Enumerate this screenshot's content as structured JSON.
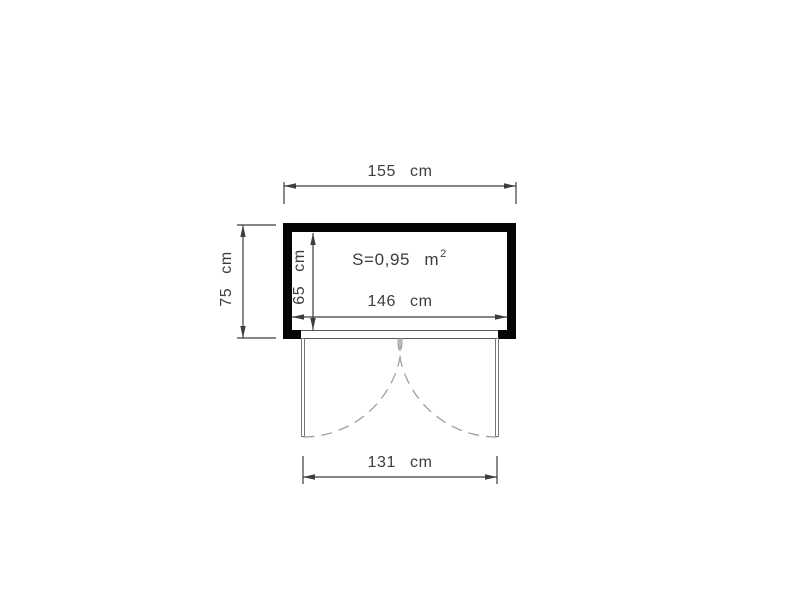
{
  "drawing": {
    "area": {
      "full_text": "S=0,95 m²",
      "prefix": "S=0,95 m",
      "exponent": "2"
    },
    "dimensions": {
      "overall_width": {
        "label": "155 cm",
        "value_cm": 155
      },
      "overall_depth": {
        "label": "75 cm",
        "value_cm": 75
      },
      "inner_depth": {
        "label": "65 cm",
        "value_cm": 65
      },
      "inner_width": {
        "label": "146 cm",
        "value_cm": 146
      },
      "door_opening_width": {
        "label": "131 cm",
        "value_cm": 131
      }
    },
    "colors": {
      "background": "#ffffff",
      "wall": "#000000",
      "dimension_line": "#3d3d3d",
      "thin_line": "#555555",
      "door_leaf_line": "#777777",
      "door_swing_dash": "#9a9a9a",
      "text": "#3d3d3d"
    }
  }
}
